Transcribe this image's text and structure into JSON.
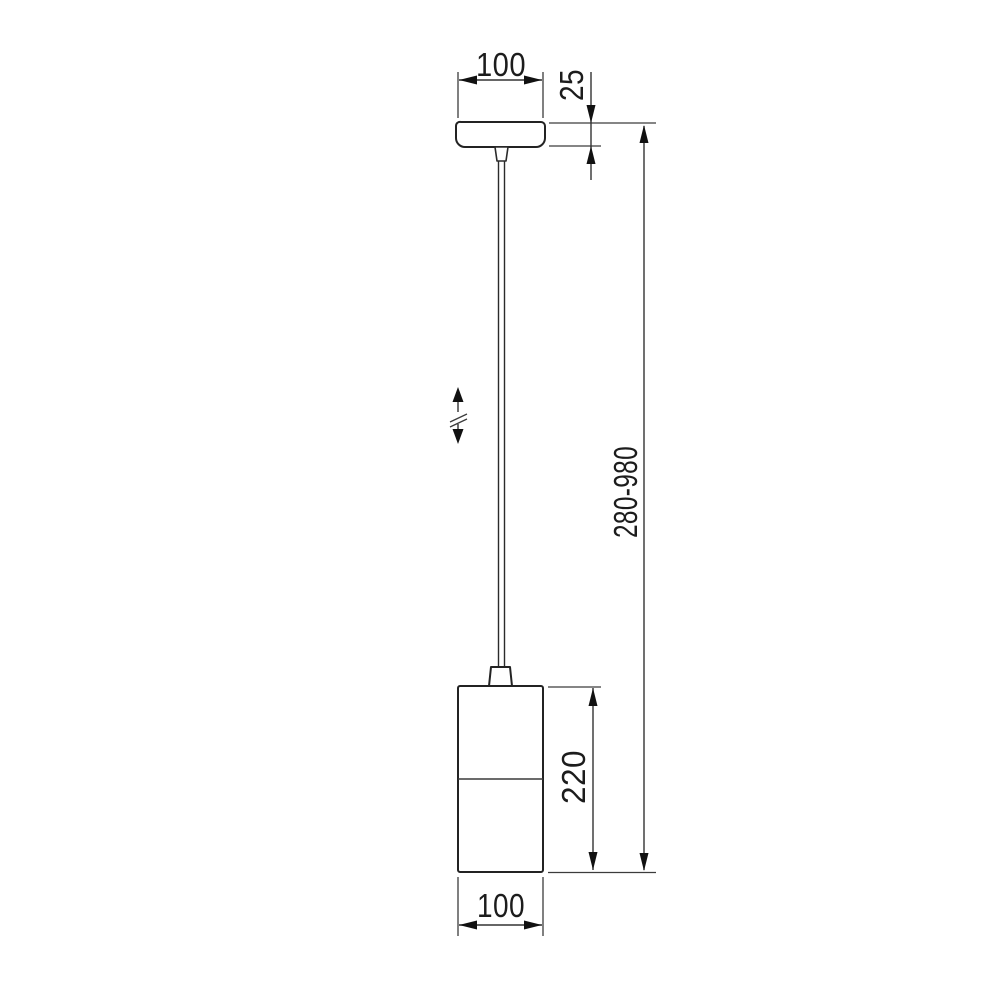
{
  "drawing": {
    "kind": "technical-dimension-drawing",
    "subject": "pendant-lamp",
    "background_color": "#ffffff",
    "line_color": "#232323",
    "arrow_color": "#111111",
    "icons": {
      "height_adjust": "double-arrow-with-break-icon"
    },
    "dimensions": {
      "canopy_width": "100",
      "canopy_height": "25",
      "overall_height_range": "280-980",
      "shade_height": "220",
      "shade_width": "100"
    }
  }
}
